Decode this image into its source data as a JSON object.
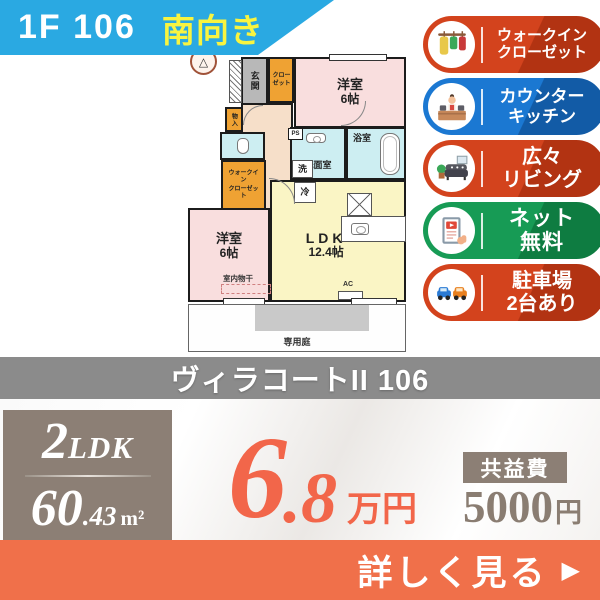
{
  "ribbon": {
    "unit": "1F 106",
    "facing": "南向き"
  },
  "features": [
    {
      "line1": "ウォークイン",
      "line2": "クローゼット",
      "color": "#d3431d",
      "icon": "closet-icon"
    },
    {
      "line1": "カウンター",
      "line2": "キッチン",
      "color": "#1b78d2",
      "icon": "kitchen-icon"
    },
    {
      "line1": "広々",
      "line2": "リビング",
      "color": "#d3431d",
      "icon": "sofa-icon"
    },
    {
      "line1": "ネット",
      "line2": "無料",
      "color": "#179b55",
      "icon": "tablet-icon"
    },
    {
      "line1": "駐車場",
      "line2": "2台あり",
      "color": "#d3431d",
      "icon": "cars-icon"
    }
  ],
  "floorplan": {
    "compass": "△",
    "genkan": "玄関",
    "closet": {
      "line1": "クロー",
      "line2": "ゼット"
    },
    "bedroom_top": {
      "line1": "洋室",
      "line2": "6帖"
    },
    "storage": "物入",
    "washroom": "洗面室",
    "bathroom": "浴室",
    "washer": "洗",
    "fridge": "冷",
    "ps": "PS",
    "wic": {
      "line1": "ウォークイン",
      "line2": "クローゼット"
    },
    "ldk": {
      "line1": "LDK",
      "line2": "12.4帖"
    },
    "bedroom_bottom": {
      "line1": "洋室",
      "line2": "6帖"
    },
    "indoor_drying": "室内物干",
    "ac": "AC",
    "garden": "専用庭"
  },
  "title": "ヴィラコートII 106",
  "spec": {
    "layout_num": "2",
    "layout_type": "LDK",
    "area_int": "60",
    "area_frac": ".43",
    "area_unit": "m²"
  },
  "price": {
    "amount_int": "6",
    "amount_frac": ".8",
    "unit": "万円",
    "color": "#f2664a"
  },
  "fee": {
    "label": "共益費",
    "amount": "5000",
    "unit": "円"
  },
  "cta": {
    "label": "詳しく見る",
    "arrow": "▶"
  }
}
